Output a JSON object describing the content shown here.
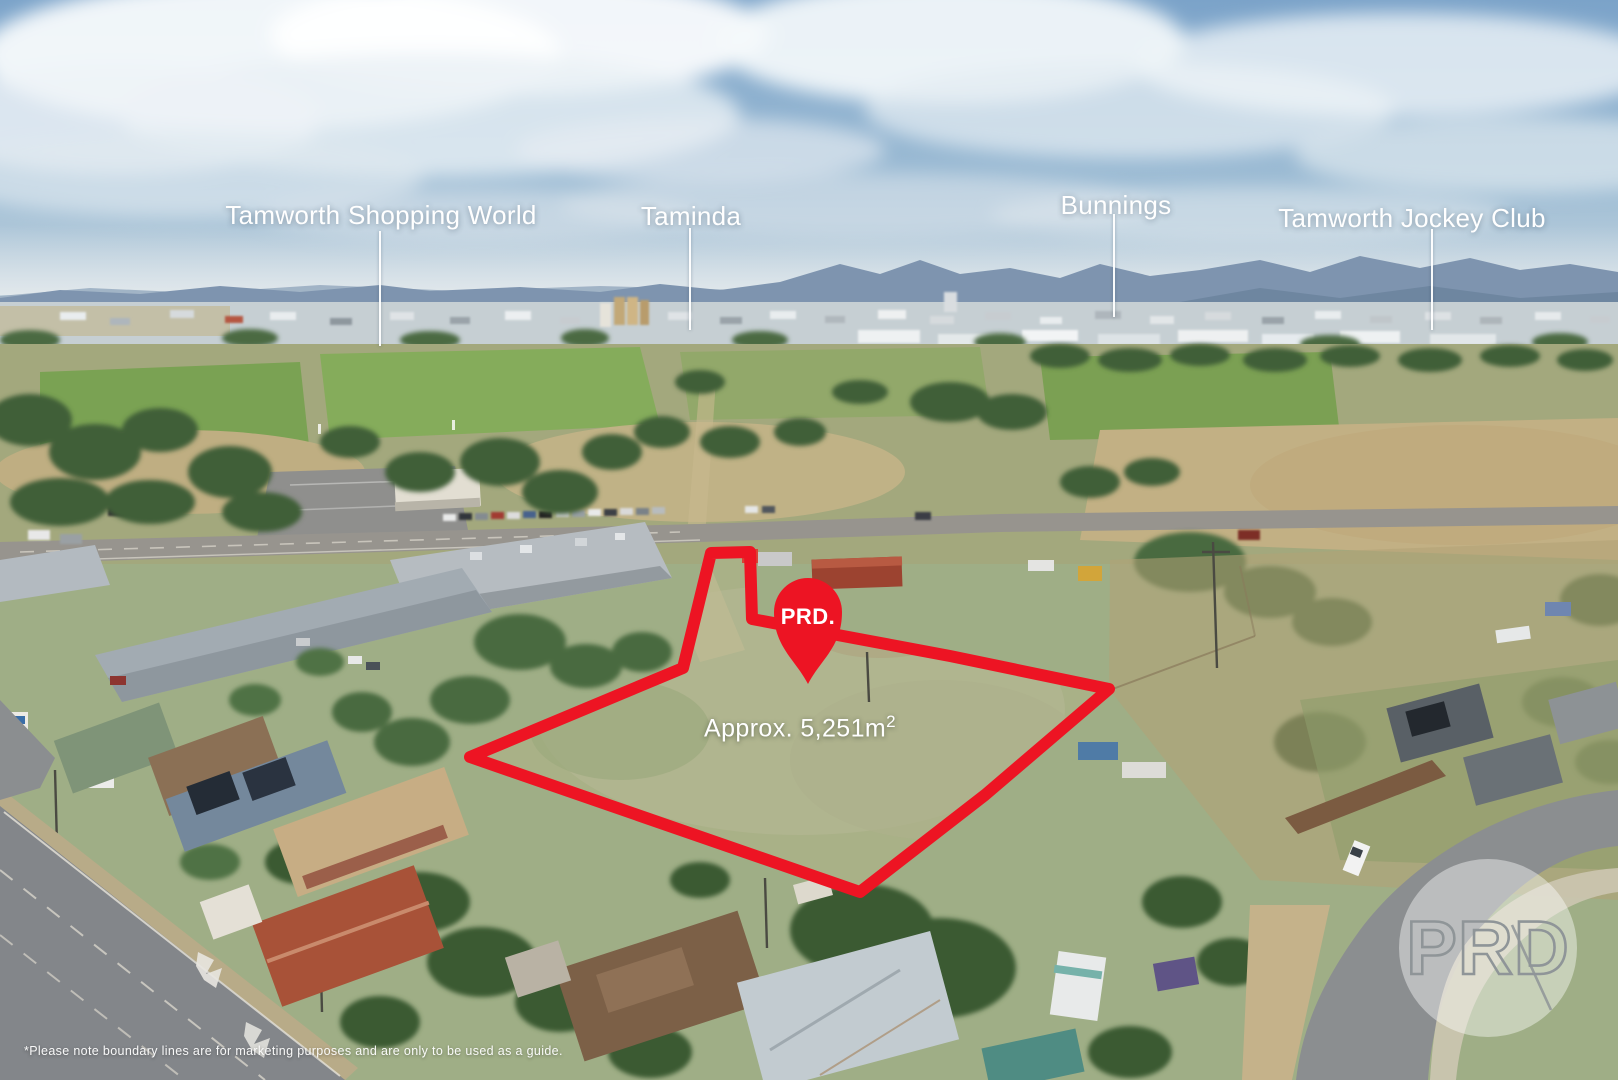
{
  "annotations": {
    "landmark_labels": [
      {
        "label": "Tamworth Shopping World"
      },
      {
        "label": "Taminda"
      },
      {
        "label": "Bunnings"
      },
      {
        "label": "Tamworth Jockey Club"
      }
    ],
    "pin": {
      "brand": "PRD."
    },
    "area_label": {
      "base": "Approx. 5,251m",
      "exponent": "2"
    },
    "watermark": {
      "brand": "PRD"
    },
    "disclaimer": "*Please note boundary lines are for marketing purposes and are only to be used as a guide.",
    "colors": {
      "boundary_red": "#ed1423",
      "label_white": "#ffffff"
    }
  }
}
